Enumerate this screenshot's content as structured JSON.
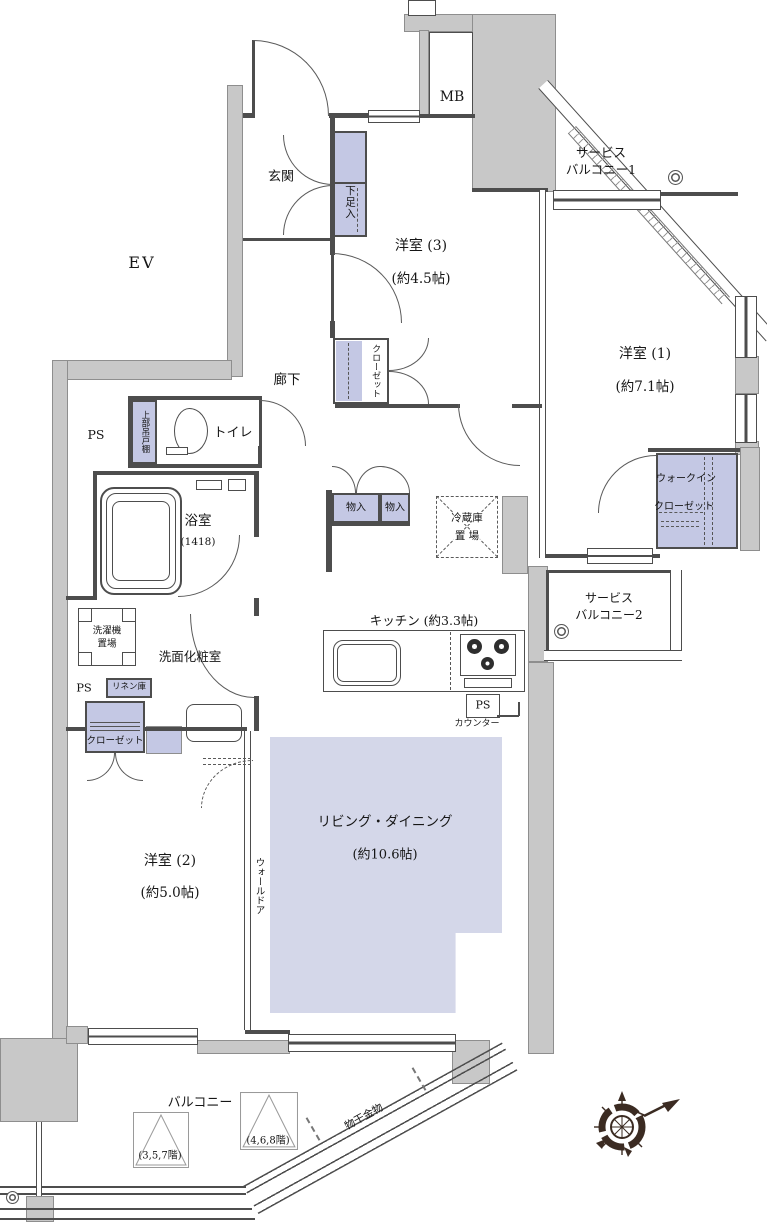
{
  "colors": {
    "wall": "#c8c8c8",
    "closet_fill": "#c4c8e4",
    "living_fill": "#d4d7e9",
    "line": "#4d4d4d",
    "compass": "#3b2b22"
  },
  "labels": {
    "ev": "EV",
    "genkan": "玄関",
    "shoe_cabinet": "下足入",
    "mb": "MB",
    "service_balcony1_l1": "サービス",
    "service_balcony1_l2": "バルコニー1",
    "bedroom3_name": "洋室 (3)",
    "bedroom3_size": "(約4.5帖)",
    "bedroom3_closet": "クローゼット",
    "bedroom1_name": "洋室 (1)",
    "bedroom1_size": "(約7.1帖)",
    "wic_l1": "ウォークイン",
    "wic_l2": "クローゼット",
    "hallway": "廊下",
    "toilet": "トイレ",
    "ps_upper": "PS",
    "upper_cabinet": "上部吊戸棚",
    "bath_name": "浴室",
    "bath_size": "(1418)",
    "storage1": "物入",
    "storage2": "物入",
    "fridge_l1": "冷蔵庫",
    "fridge_l2": "置 場",
    "service_balcony2_l1": "サービス",
    "service_balcony2_l2": "バルコニー2",
    "washer_l1": "洗濯機",
    "washer_l2": "置場",
    "powder_room": "洗面化粧室",
    "ps_mid": "PS",
    "linen": "リネン庫",
    "bedroom2_closet": "クローゼット",
    "kitchen": "キッチン (約3.3帖)",
    "ps_kitchen": "PS",
    "counter": "カウンター",
    "living_name": "リビング・ダイニング",
    "living_size": "(約10.6帖)",
    "bedroom2_name": "洋室 (2)",
    "bedroom2_size": "(約5.0帖)",
    "wall_door": "ウォールドア",
    "balcony": "バルコニー",
    "hatch_357": "(3,5,7階)",
    "hatch_468": "(4,6,8階)",
    "drying_fixture": "物干金物"
  }
}
